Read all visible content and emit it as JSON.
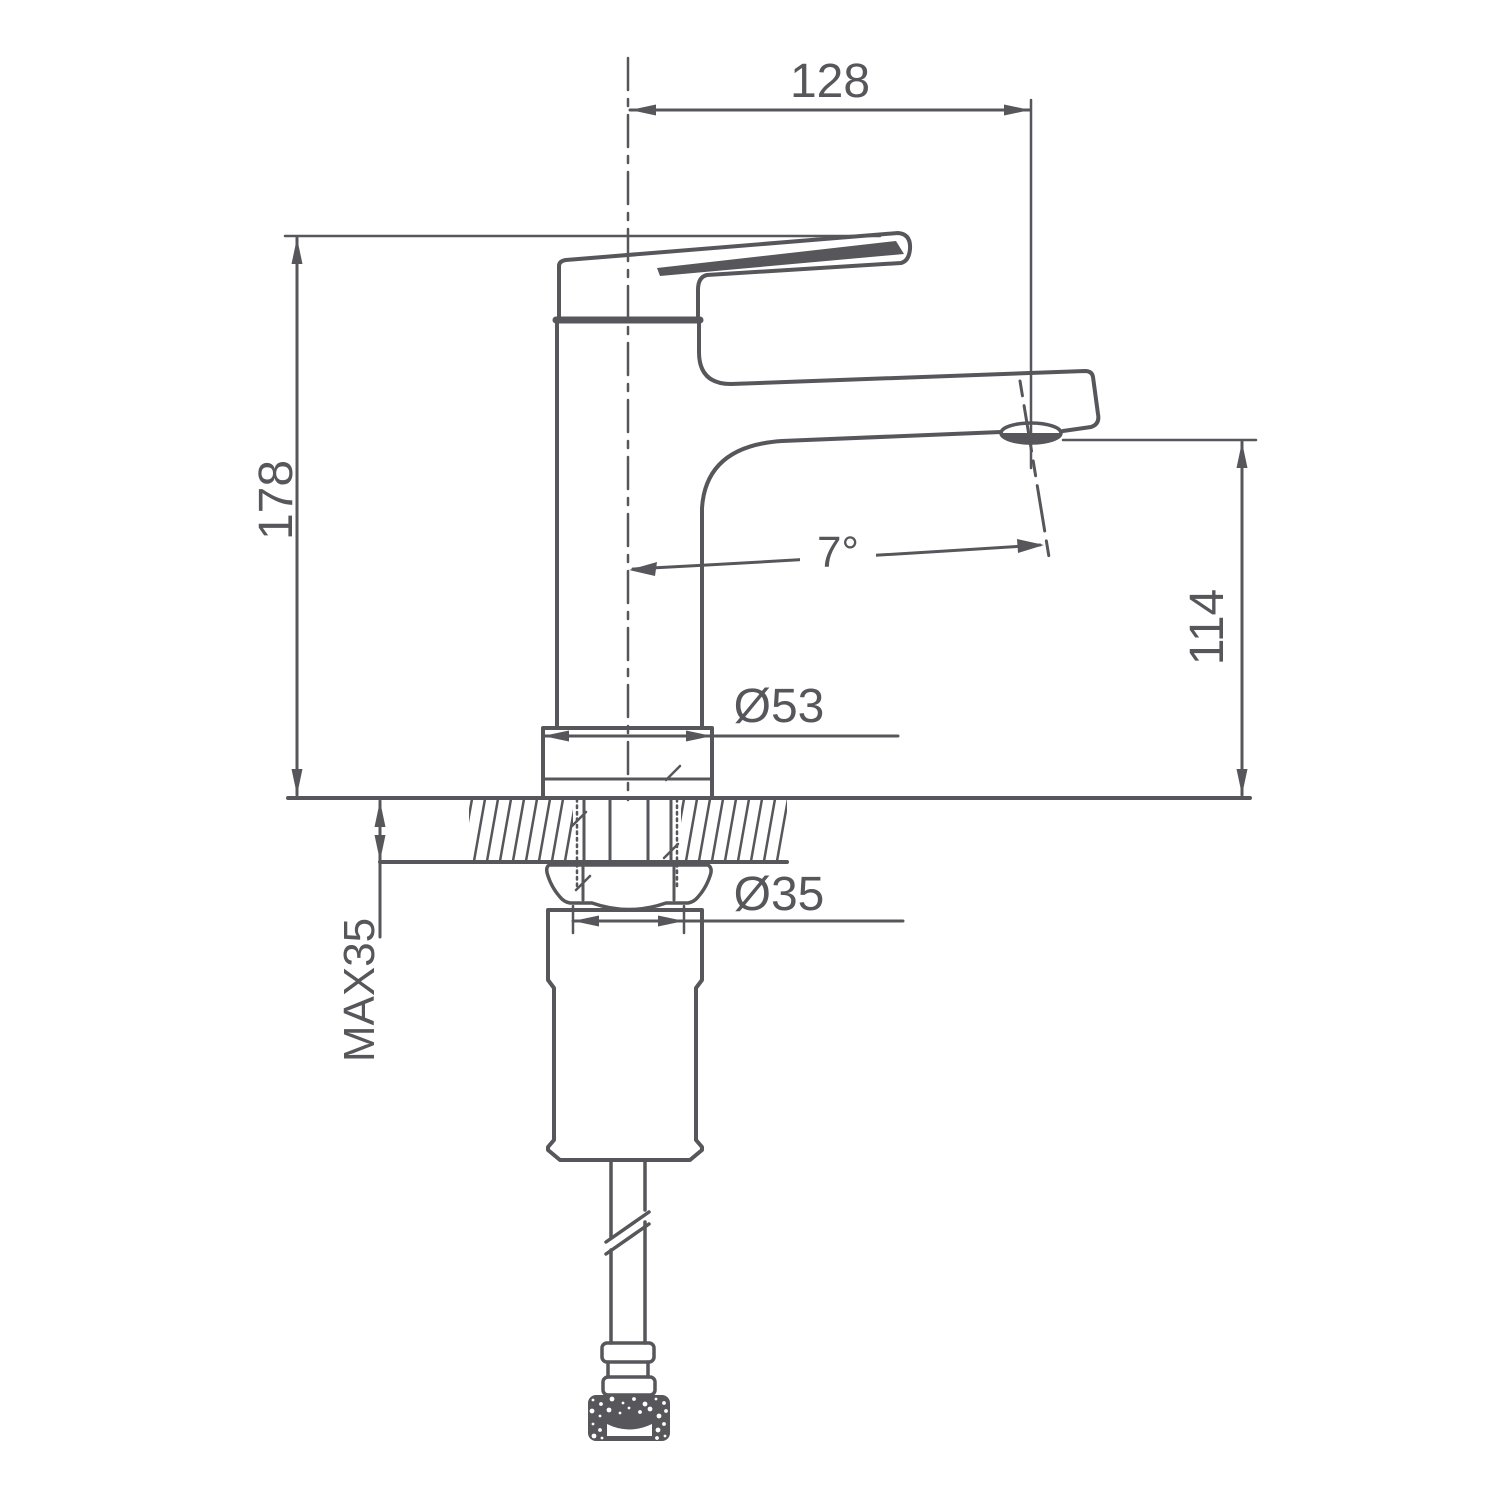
{
  "drawing": {
    "type": "technical-dimension-drawing",
    "subject": "single-lever basin faucet, side elevation with mounting section",
    "line_color": "#57575b",
    "background_color": "#ffffff",
    "dimensions": {
      "spout_reach": "128",
      "overall_height": "178",
      "spout_outlet_height": "114",
      "max_deck_thickness": "MAX35",
      "base_diameter": "Ø53",
      "shank_diameter": "Ø35",
      "spout_angle": "7°"
    }
  }
}
